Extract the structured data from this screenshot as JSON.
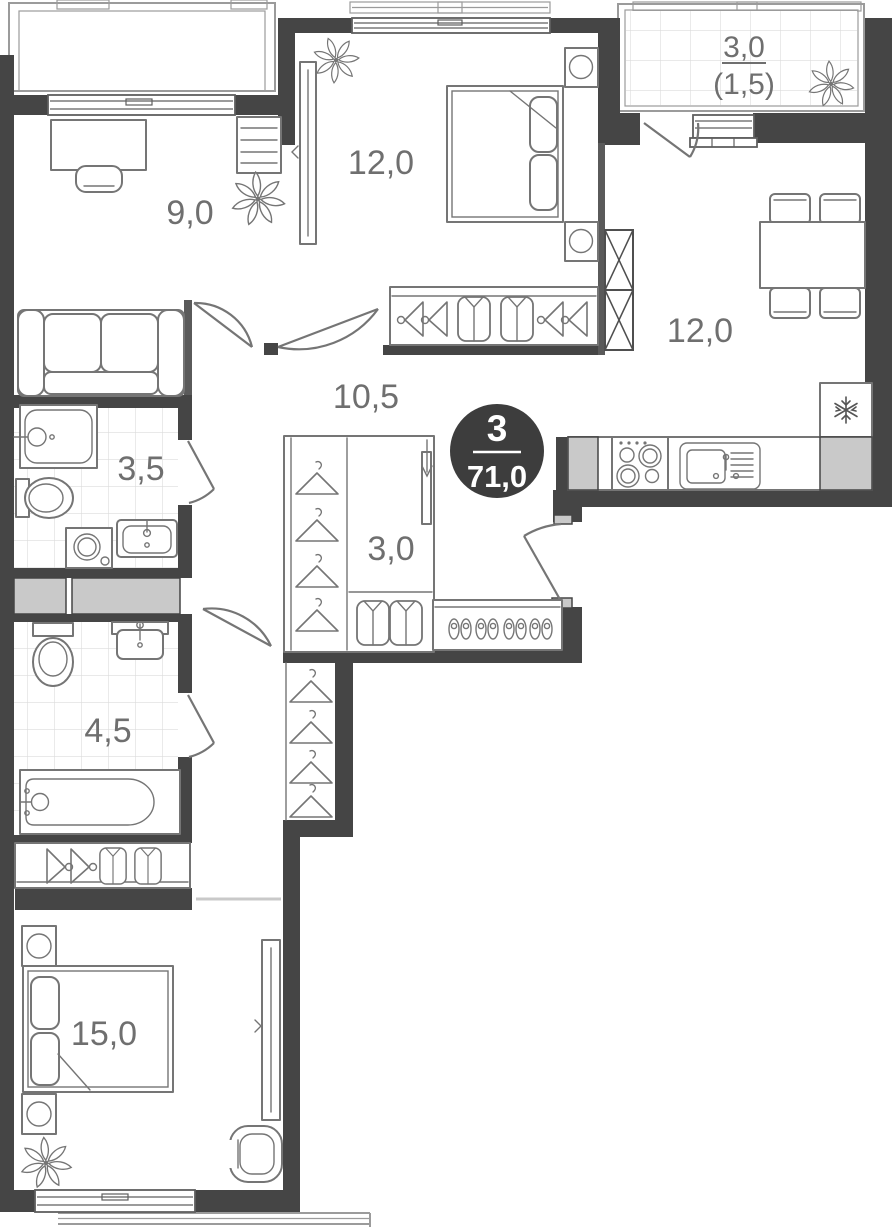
{
  "plan": {
    "type_badge": {
      "rooms_count": "3",
      "total_area": "71,0"
    },
    "rooms": {
      "cabinet": {
        "label": "9,0"
      },
      "bedroom_top": {
        "label": "12,0"
      },
      "loggia": {
        "label": "3,0",
        "label_reduced": "(1,5)"
      },
      "kitchen_living": {
        "label": "12,0"
      },
      "hallway": {
        "label": "10,5"
      },
      "bathroom_small": {
        "label": "3,5"
      },
      "wardrobe": {
        "label": "3,0"
      },
      "bathroom_large": {
        "label": "4,5"
      },
      "bedroom_main": {
        "label": "15,0"
      }
    },
    "colors": {
      "wall": "#454545",
      "badge_bg": "#3d3d3d",
      "badge_text": "#ffffff",
      "furniture_line": "#757575",
      "label_text": "#6f6f6f",
      "tile_line": "#dcdcdc",
      "shaft_fill": "#c9c9c9"
    }
  }
}
